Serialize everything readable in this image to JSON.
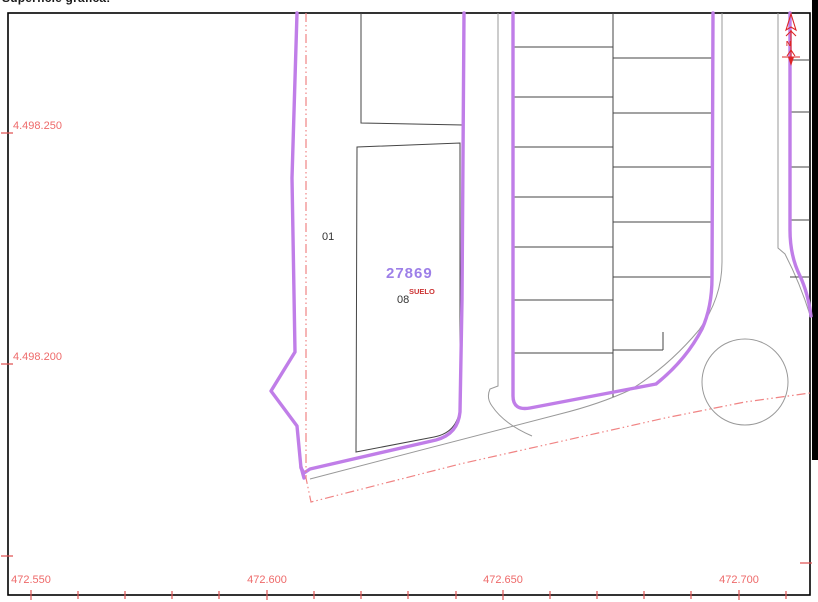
{
  "header": {
    "clipped_text": "Superficie gráfica:"
  },
  "axes": {
    "x_labels": [
      "472.550",
      "472.600",
      "472.650",
      "472.700"
    ],
    "y_labels": [
      "4.498.250",
      "4.498.200"
    ]
  },
  "parcel": {
    "number": "27869",
    "subparcel_code": "08",
    "land_use": "SUELO",
    "adjacent_code": "01"
  },
  "north": {
    "label": "N"
  },
  "colors": {
    "boundary_purple": "#c07ee8",
    "parcel_number_purple": "#9d7fe8",
    "parcel_green": "#cdf3cd",
    "axis_label_red": "#ee6a6a",
    "tick_red": "#e05555",
    "dash_boundary_red": "#f08484",
    "north_red": "#dd2525",
    "line_gray": "#999999",
    "line_dark": "#454545"
  }
}
